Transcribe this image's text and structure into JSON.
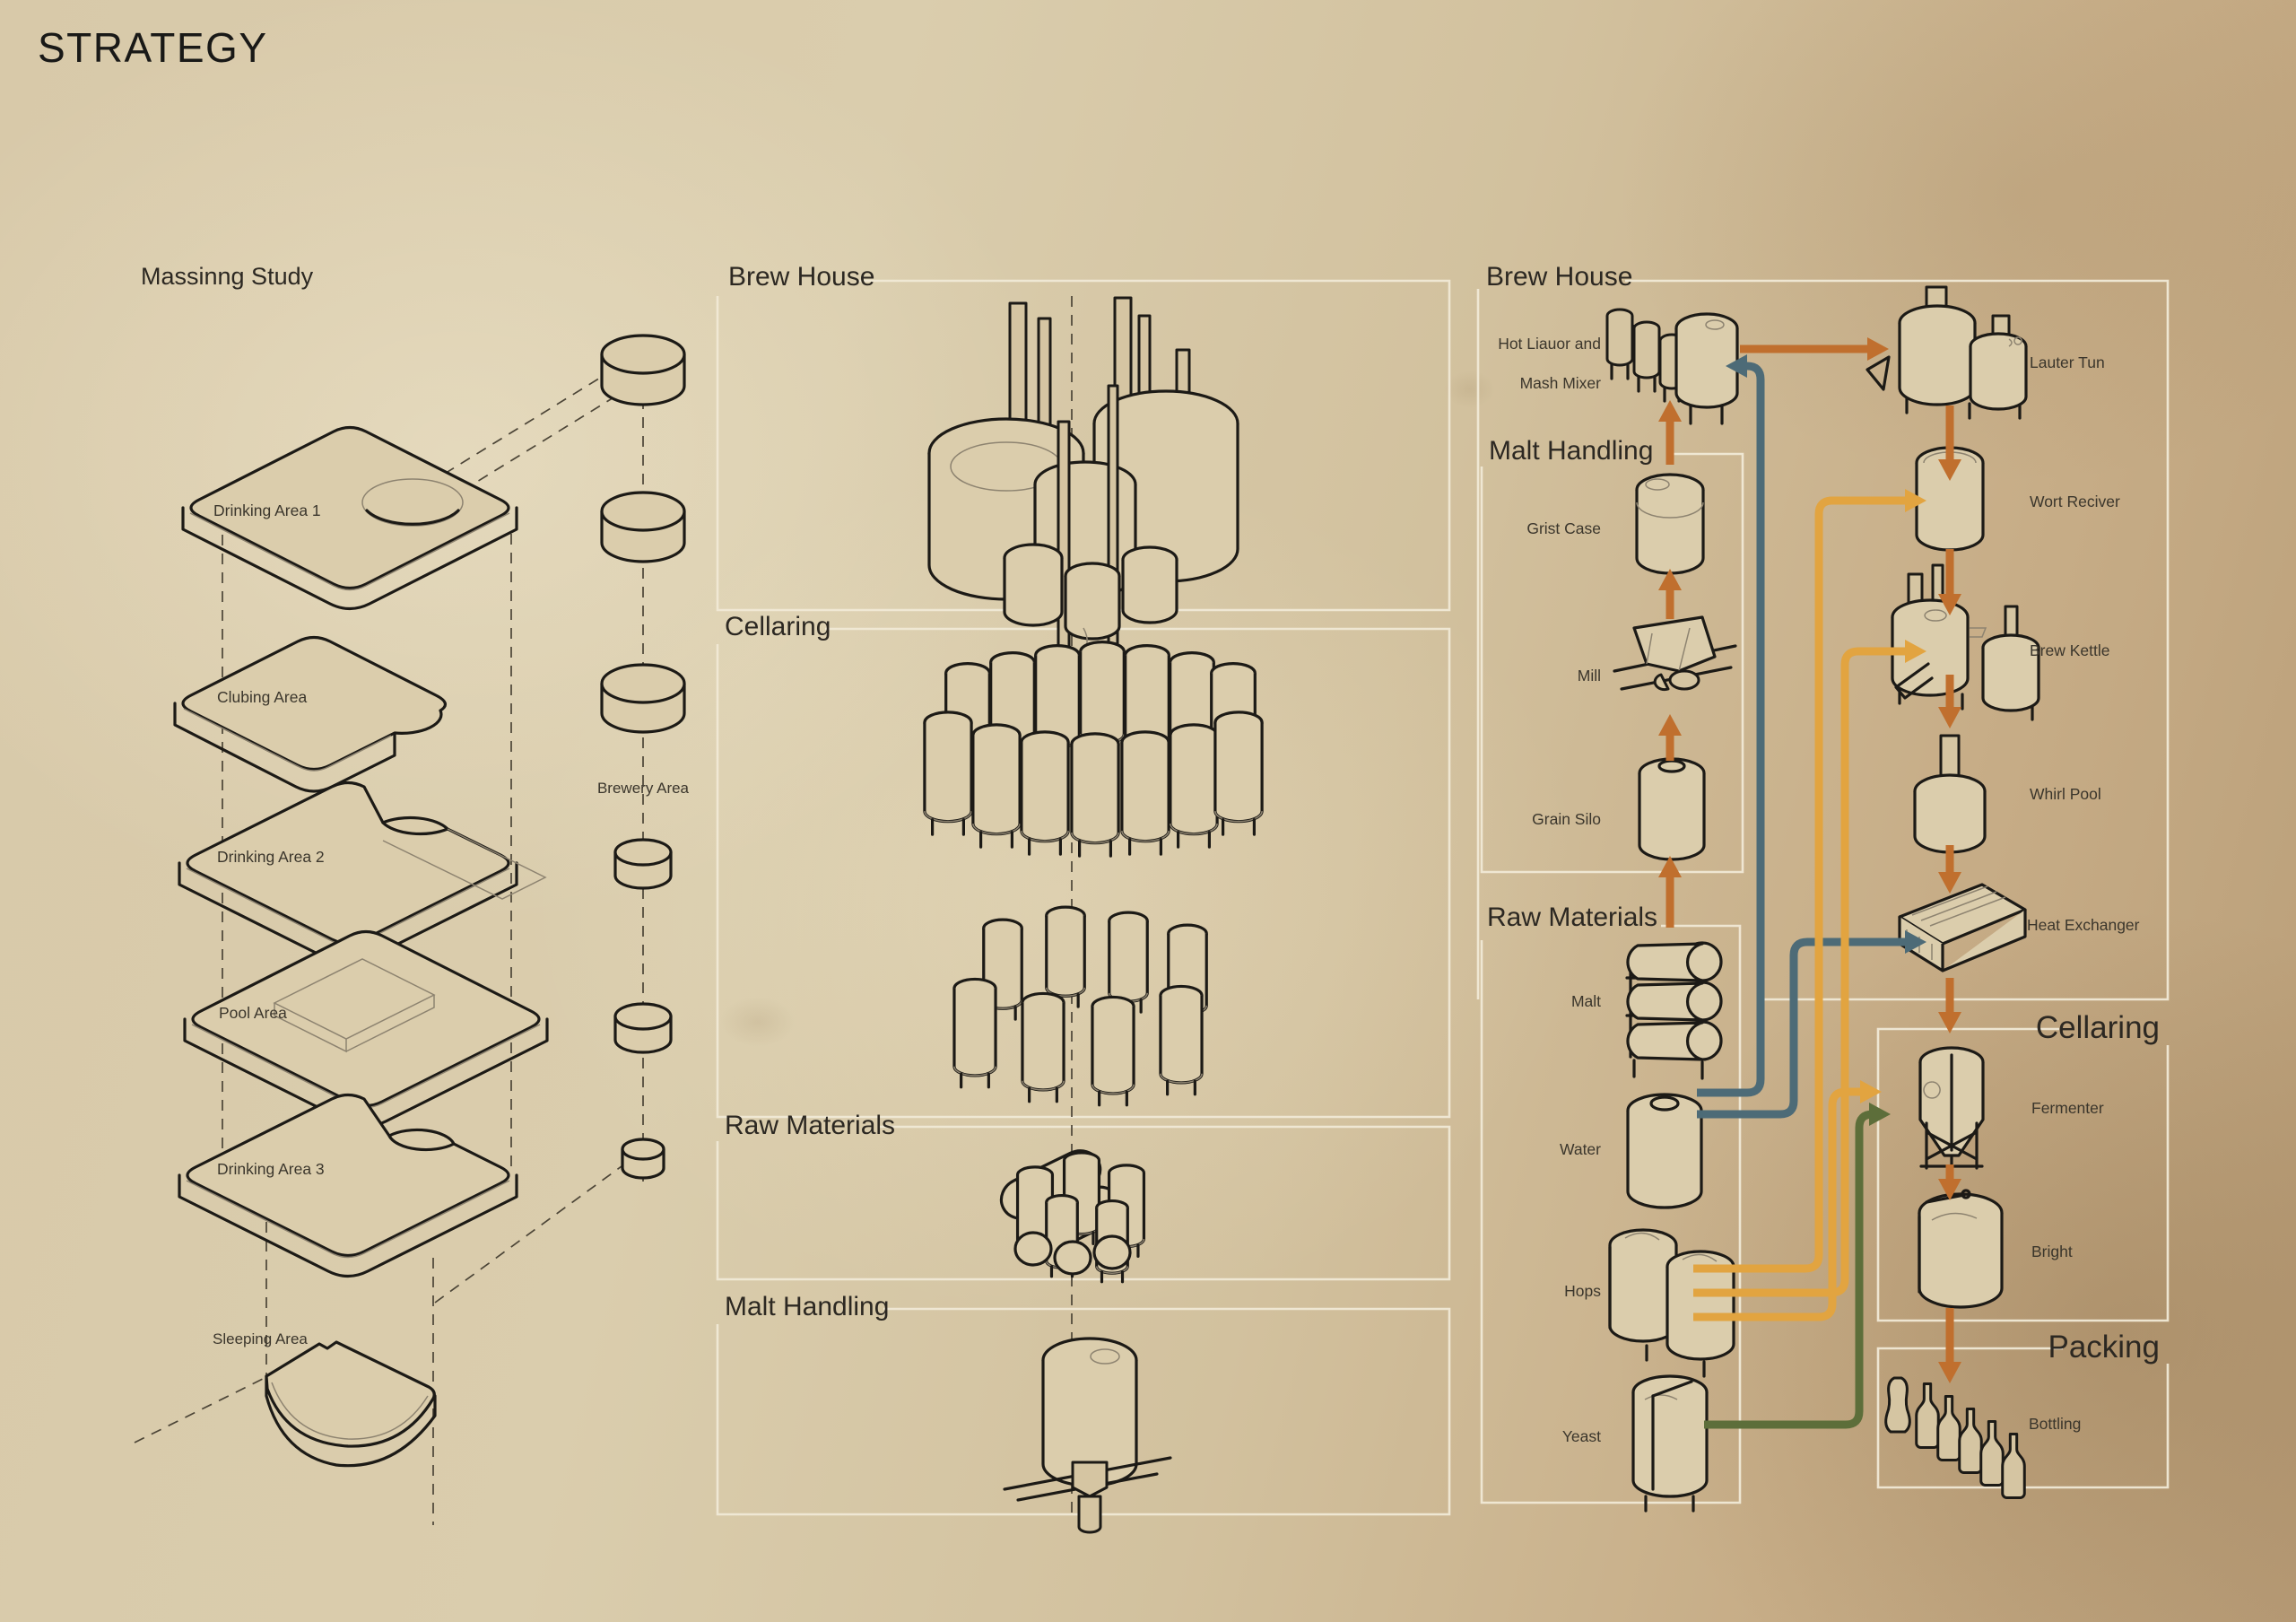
{
  "title": "STRATEGY",
  "colors": {
    "paper": "#d5c5a3",
    "ink": "#1c1a16",
    "box_border": "#f0e9d6",
    "orange": "#c06f2e",
    "amber": "#e2a440",
    "teal": "#4d6b77",
    "green": "#5d6e3a"
  },
  "massing": {
    "heading": "Massinng Study",
    "plates": [
      {
        "label": "Drinking Area 1"
      },
      {
        "label": "Clubing Area"
      },
      {
        "label": "Drinking Area 2"
      },
      {
        "label": "Pool Area"
      },
      {
        "label": "Drinking Area 3"
      },
      {
        "label": "Sleeping Area"
      }
    ],
    "column_label": "Brewery Area"
  },
  "overview": {
    "sections": [
      {
        "title": "Brew House"
      },
      {
        "title": "Cellaring"
      },
      {
        "title": "Raw Materials"
      },
      {
        "title": "Malt Handling"
      }
    ]
  },
  "flow": {
    "brew_house": {
      "title": "Brew House"
    },
    "mixer": {
      "line1": "Hot Liauor and",
      "line2": "Mash Mixer"
    },
    "malt_handling": {
      "title": "Malt Handling",
      "items": [
        {
          "label": "Grist Case"
        },
        {
          "label": "Mill"
        },
        {
          "label": "Grain Silo"
        }
      ]
    },
    "raw_materials": {
      "title": "Raw Materials",
      "items": [
        {
          "label": "Malt"
        },
        {
          "label": "Water"
        },
        {
          "label": "Hops"
        },
        {
          "label": "Yeast"
        }
      ]
    },
    "stations": [
      {
        "label": "Lauter Tun"
      },
      {
        "label": "Wort Reciver"
      },
      {
        "label": "Brew Kettle"
      },
      {
        "label": "Whirl Pool"
      },
      {
        "label": "Heat Exchanger"
      }
    ],
    "cellaring": {
      "title": "Cellaring",
      "items": [
        {
          "label": "Fermenter"
        },
        {
          "label": "Bright"
        }
      ]
    },
    "packing": {
      "title": "Packing",
      "items": [
        {
          "label": "Bottling"
        }
      ]
    }
  }
}
